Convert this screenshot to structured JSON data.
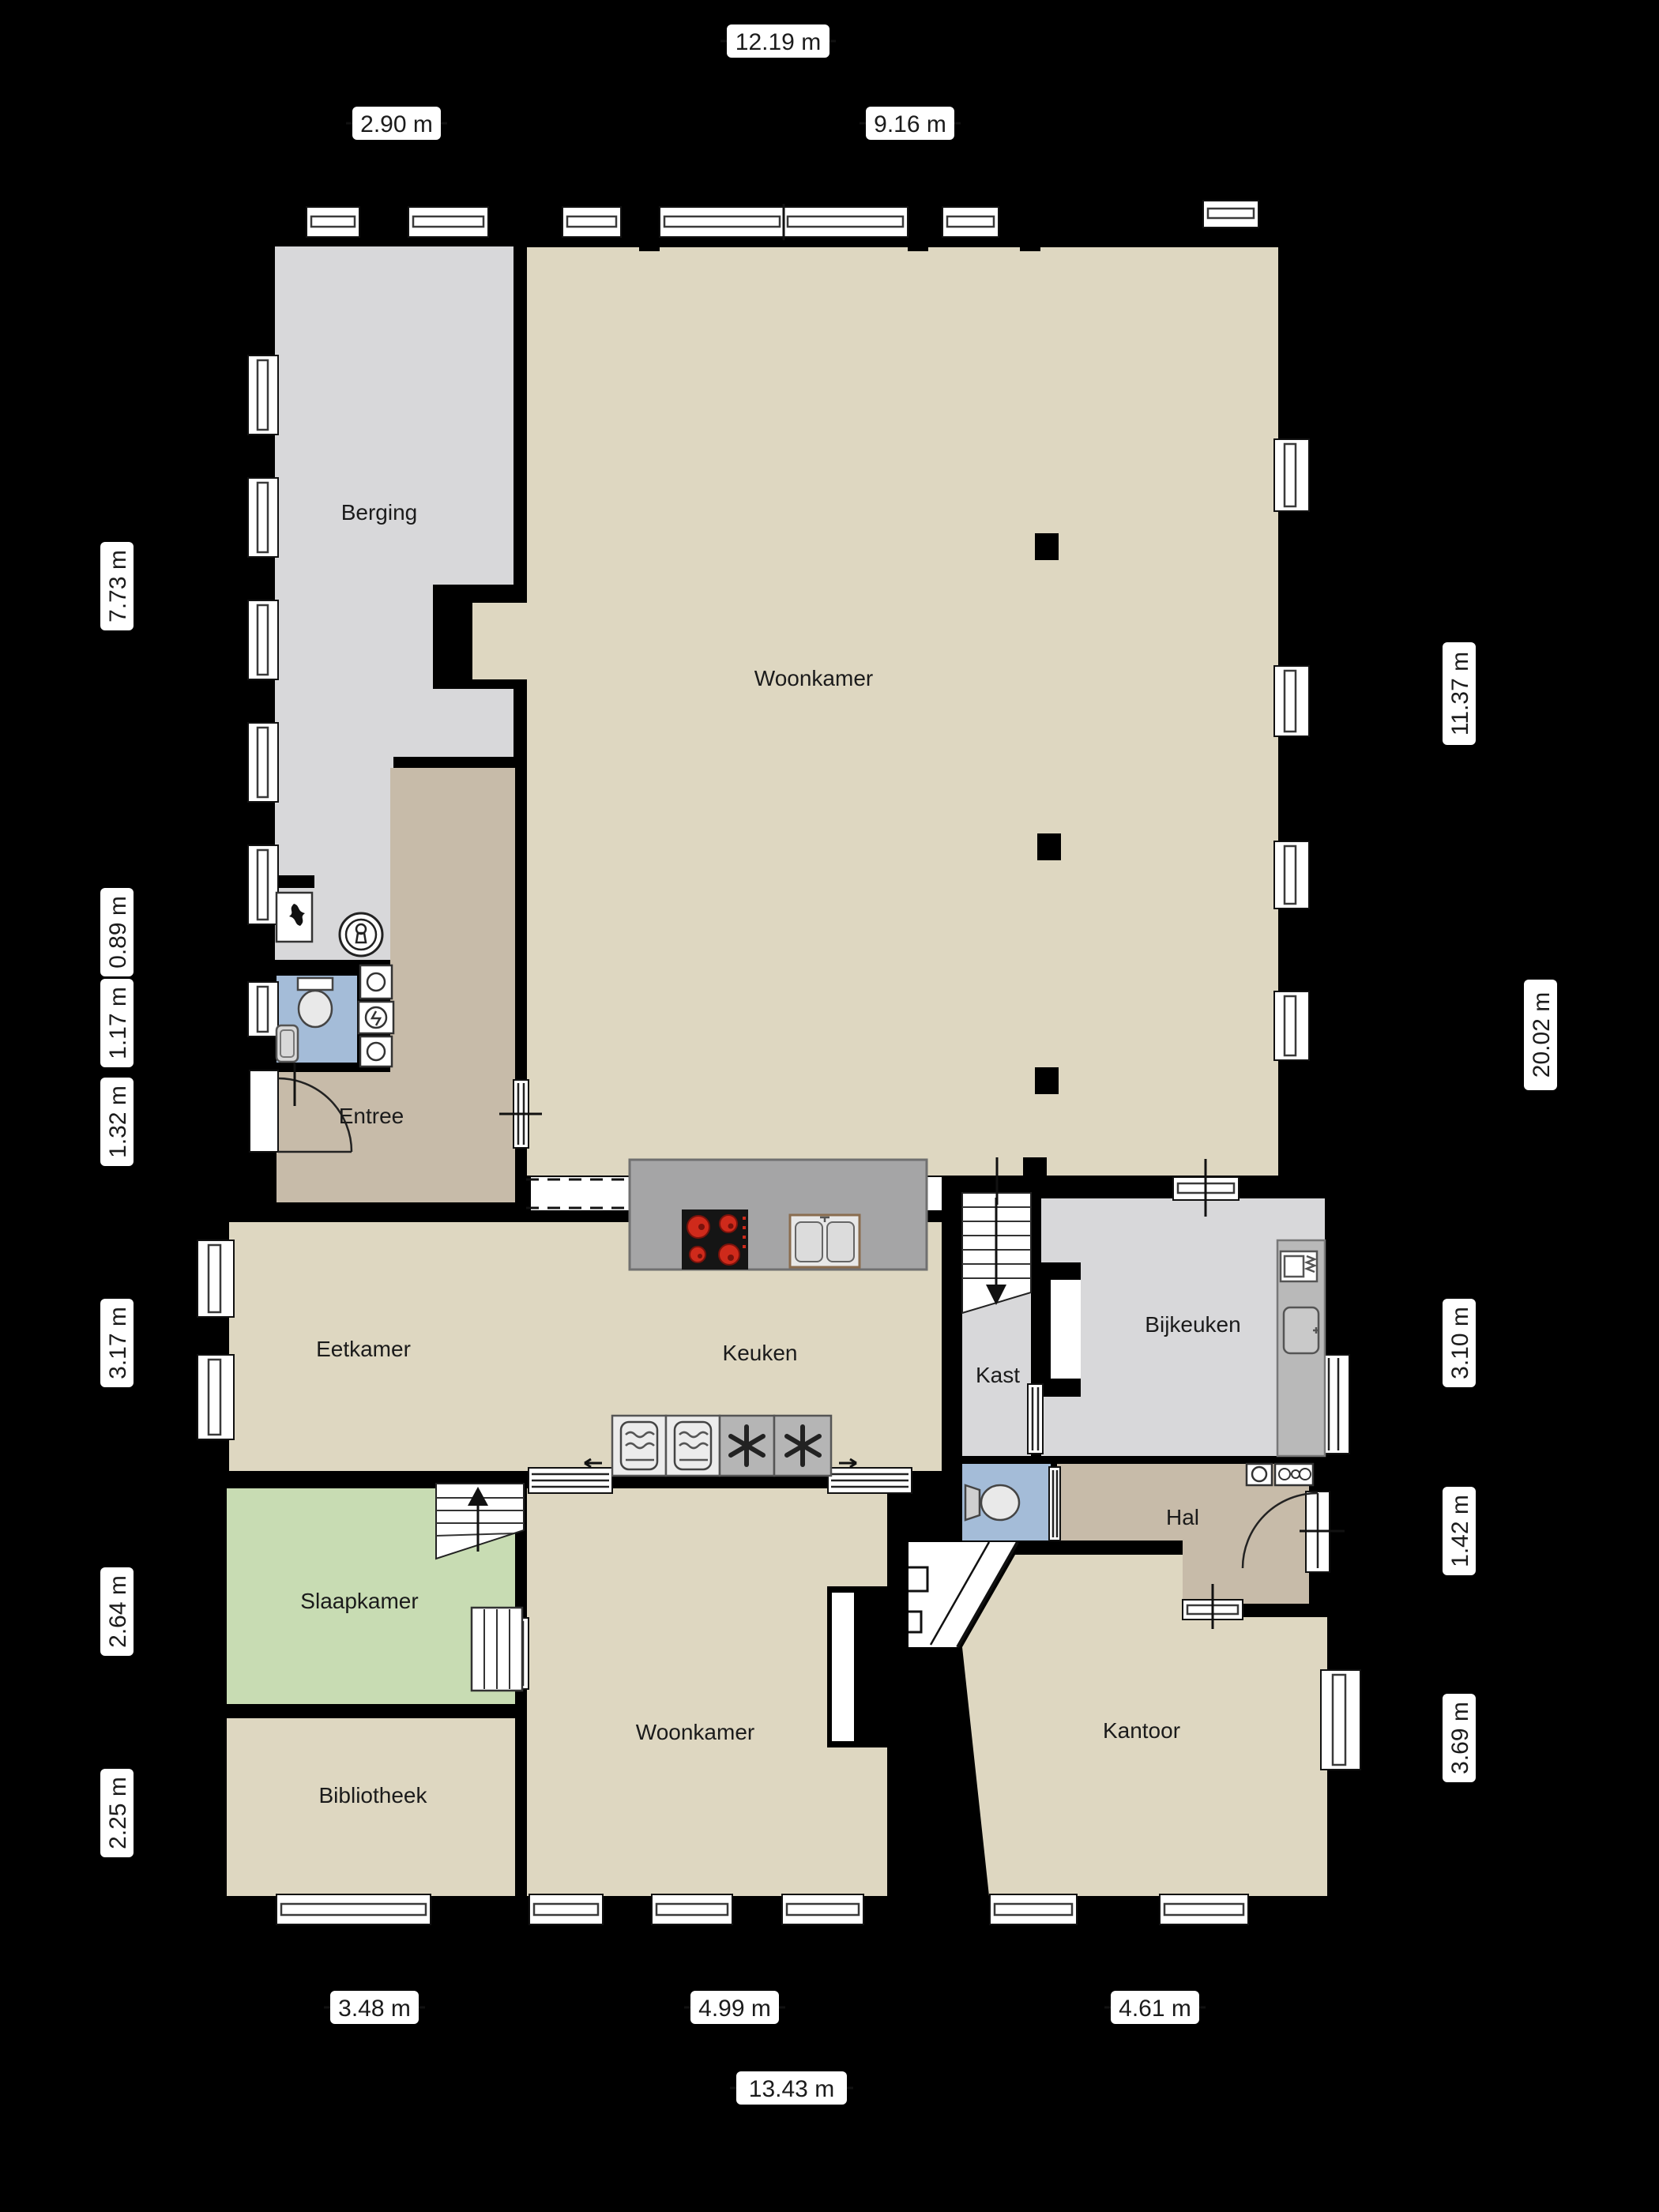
{
  "plan_type": "floorplan",
  "language": "nl",
  "rooms": [
    {
      "id": "berging",
      "label": "Berging"
    },
    {
      "id": "woonkamer-top",
      "label": "Woonkamer"
    },
    {
      "id": "entree",
      "label": "Entree"
    },
    {
      "id": "eetkamer",
      "label": "Eetkamer"
    },
    {
      "id": "keuken",
      "label": "Keuken"
    },
    {
      "id": "kast",
      "label": "Kast"
    },
    {
      "id": "bijkeuken",
      "label": "Bijkeuken"
    },
    {
      "id": "hal",
      "label": "Hal"
    },
    {
      "id": "slaapkamer",
      "label": "Slaapkamer"
    },
    {
      "id": "woonkamer-bottom",
      "label": "Woonkamer"
    },
    {
      "id": "kantoor",
      "label": "Kantoor"
    },
    {
      "id": "bibliotheek",
      "label": "Bibliotheek"
    }
  ],
  "dims": {
    "top": [
      "12.19 m",
      "2.90 m",
      "9.16 m"
    ],
    "left": [
      "7.73 m",
      "0.89 m",
      "1.17 m",
      "1.32 m",
      "3.17 m",
      "2.64 m",
      "2.25 m"
    ],
    "right": [
      "11.37 m",
      "20.02 m",
      "3.10 m",
      "1.42 m",
      "3.69 m"
    ],
    "bottom": [
      "3.48 m",
      "4.99 m",
      "4.61 m",
      "13.43 m"
    ]
  },
  "fixtures": [
    "staircase-up",
    "staircase-down",
    "toilet",
    "hand-basin",
    "washing-machine",
    "boiler",
    "meter-cupboard",
    "cooktop",
    "kitchen-sink",
    "oven",
    "freezer",
    "utility-sink",
    "wardrobe",
    "fireplace",
    "entry-door",
    "interior-door",
    "sliding-door",
    "window"
  ],
  "colors": {
    "background": "#000000",
    "floor_beige": "#ded7c1",
    "floor_gray": "#d8d8da",
    "floor_tan": "#c7bba9",
    "floor_green": "#c8dcb3",
    "floor_blue": "#a4bcd8",
    "island_gray": "#a5a5a6",
    "counter_gray": "#b9b9b9",
    "burner_red": "#cf2a1b",
    "label_text": "#1b1b1b"
  }
}
